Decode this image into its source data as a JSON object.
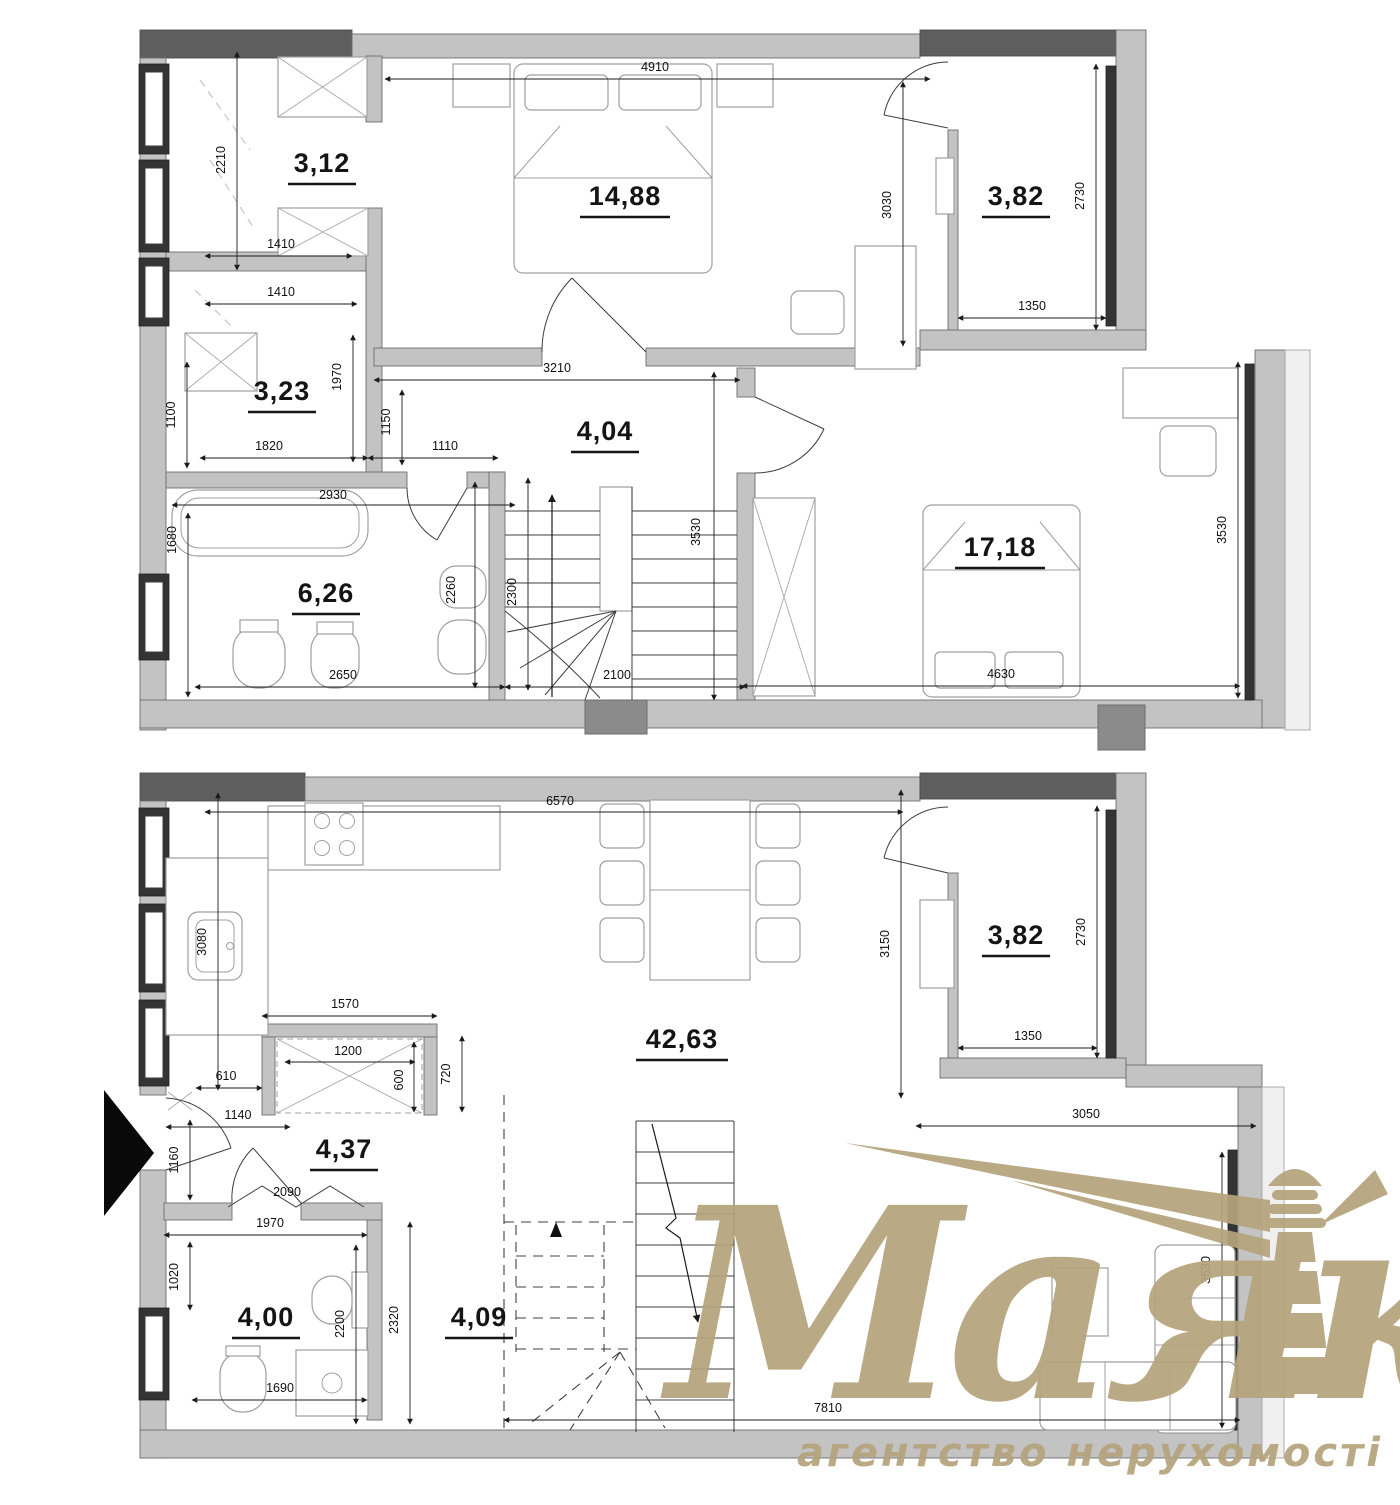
{
  "watermark": {
    "name": "Маяк",
    "tagline": "агентство нерухомості",
    "color": "#b5a37c",
    "icon": "lighthouse-icon"
  },
  "floors": [
    {
      "id": "upper-level",
      "rooms": [
        {
          "id": "wardrobe-room",
          "area": "3,12"
        },
        {
          "id": "bedroom",
          "area": "14,88"
        },
        {
          "id": "balcony",
          "area": "3,82"
        },
        {
          "id": "closet-room",
          "area": "3,23"
        },
        {
          "id": "hallway",
          "area": "4,04"
        },
        {
          "id": "bathroom",
          "area": "6,26"
        },
        {
          "id": "bedroom-2",
          "area": "17,18"
        }
      ],
      "dims": {
        "top_width": "4910",
        "wardrobe_height": "2210",
        "wardrobe_width": "1410",
        "wardrobe_width2": "1410",
        "bedroom_height": "3030",
        "balcony_height": "2730",
        "balcony_width": "1350",
        "closet_left": "1100",
        "closet_width": "1820",
        "closet_height": "1970",
        "hall_width": "3210",
        "hall_left": "1150",
        "hall_door": "1110",
        "bath_top": "2930",
        "bath_left": "1680",
        "bath_bottom": "2650",
        "wc_depth": "2260",
        "stairs_left": "2300",
        "stairs_height": "3530",
        "stairs_width": "2100",
        "room2_width": "4630",
        "room2_height": "3530"
      }
    },
    {
      "id": "lower-level",
      "rooms": [
        {
          "id": "living-kitchen",
          "area": "42,63"
        },
        {
          "id": "hallway",
          "area": "4,37"
        },
        {
          "id": "bathroom",
          "area": "4,00"
        },
        {
          "id": "stair-hall",
          "area": "4,09"
        },
        {
          "id": "balcony",
          "area": "3,82"
        }
      ],
      "dims": {
        "top_width": "6570",
        "kitchen_left": "3080",
        "closet_top": "1570",
        "closet_inner": "1200",
        "closet_side": "600",
        "closet_depth": "720",
        "closet_offset": "610",
        "hall_top": "1140",
        "hall_left": "1160",
        "door_width": "2090",
        "bath_top": "1970",
        "bath_left": "1020",
        "bath_right": "2200",
        "stairhall_left": "2320",
        "bath_bottom": "1690",
        "balcony_left": "3150",
        "balcony_height": "2730",
        "balcony_width": "1350",
        "balcony_bottom": "3050",
        "bottom_width": "7810",
        "right_height": "3530"
      }
    }
  ]
}
